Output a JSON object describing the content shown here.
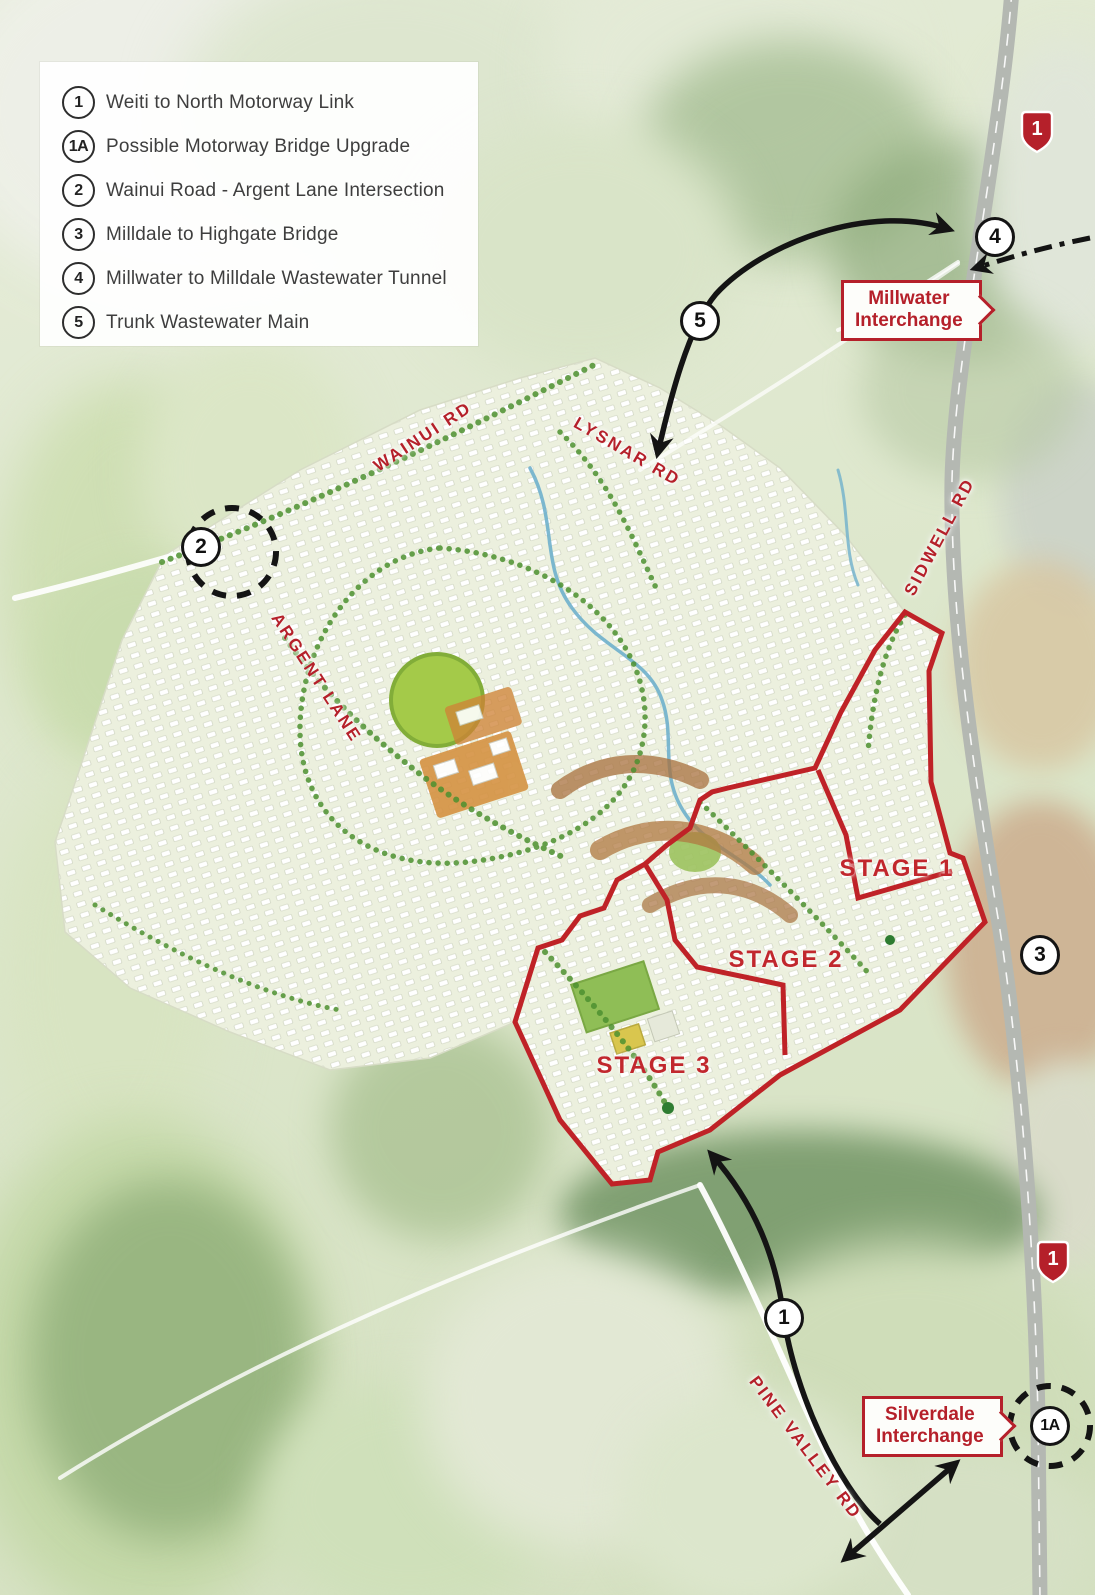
{
  "legend": {
    "items": [
      {
        "num": "1",
        "label": "Weiti to North Motorway Link"
      },
      {
        "num": "1A",
        "label": "Possible Motorway Bridge Upgrade"
      },
      {
        "num": "2",
        "label": "Wainui Road - Argent Lane Intersection"
      },
      {
        "num": "3",
        "label": "Milldale to Highgate Bridge"
      },
      {
        "num": "4",
        "label": "Millwater to Milldale Wastewater Tunnel"
      },
      {
        "num": "5",
        "label": "Trunk Wastewater Main"
      }
    ]
  },
  "roads": {
    "wainui": "WAINUI RD",
    "lysnar": "LYSNAR RD",
    "sidwell": "SIDWELL RD",
    "argent": "ARGENT LANE",
    "pine_valley": "PINE VALLEY RD"
  },
  "stages": {
    "stage1": "STAGE 1",
    "stage2": "STAGE 2",
    "stage3": "STAGE 3"
  },
  "callouts": {
    "millwater": {
      "line1": "Millwater",
      "line2": "Interchange"
    },
    "silverdale": {
      "line1": "Silverdale",
      "line2": "Interchange"
    }
  },
  "markers": {
    "m1": "1",
    "m1a": "1A",
    "m2": "2",
    "m3": "3",
    "m4": "4",
    "m5": "5"
  },
  "highway_shield": {
    "number": "1"
  },
  "colors": {
    "accent_red": "#b5202a",
    "boundary_red": "#bf2227",
    "marker_black": "#141414",
    "legend_text": "#3e3e3e",
    "shield_red": "#b5202a"
  }
}
